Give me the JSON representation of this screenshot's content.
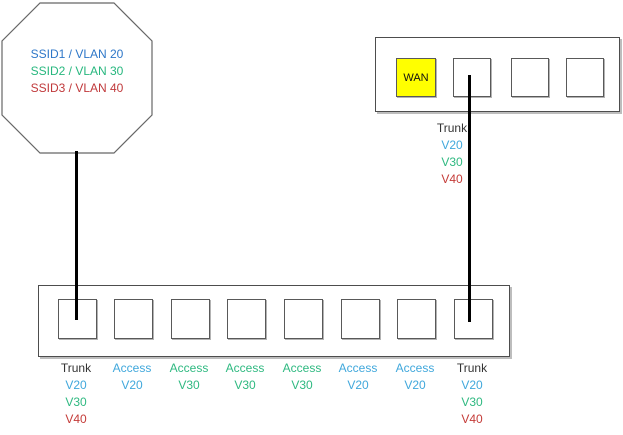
{
  "colors": {
    "ssid1_blue": "#2E77C8",
    "ssid2_green": "#27B77E",
    "ssid3_red": "#C0393B",
    "vlan20_blue": "#41A8DC",
    "vlan30_green": "#2FB981",
    "vlan40_red": "#C43B38",
    "trunk_black": "#333333",
    "wan_yellow": "#FFFF00",
    "connector_black": "#000000"
  },
  "access_point": {
    "ssids": [
      {
        "label": "SSID1 / VLAN 20"
      },
      {
        "label": "SSID2 / VLAN 30"
      },
      {
        "label": "SSID3 / VLAN 40"
      }
    ]
  },
  "router": {
    "wan_port_label": "WAN",
    "uplink_label": {
      "mode": "Trunk",
      "vlans": [
        "V20",
        "V30",
        "V40"
      ]
    }
  },
  "switch": {
    "port_labels": [
      {
        "mode": "Trunk",
        "vlans": [
          "V20",
          "V30",
          "V40"
        ]
      },
      {
        "mode": "Access",
        "vlans": [
          "V20"
        ]
      },
      {
        "mode": "Access",
        "vlans": [
          "V30"
        ]
      },
      {
        "mode": "Access",
        "vlans": [
          "V30"
        ]
      },
      {
        "mode": "Access",
        "vlans": [
          "V30"
        ]
      },
      {
        "mode": "Access",
        "vlans": [
          "V20"
        ]
      },
      {
        "mode": "Access",
        "vlans": [
          "V20"
        ]
      },
      {
        "mode": "Trunk",
        "vlans": [
          "V20",
          "V30",
          "V40"
        ]
      }
    ]
  }
}
